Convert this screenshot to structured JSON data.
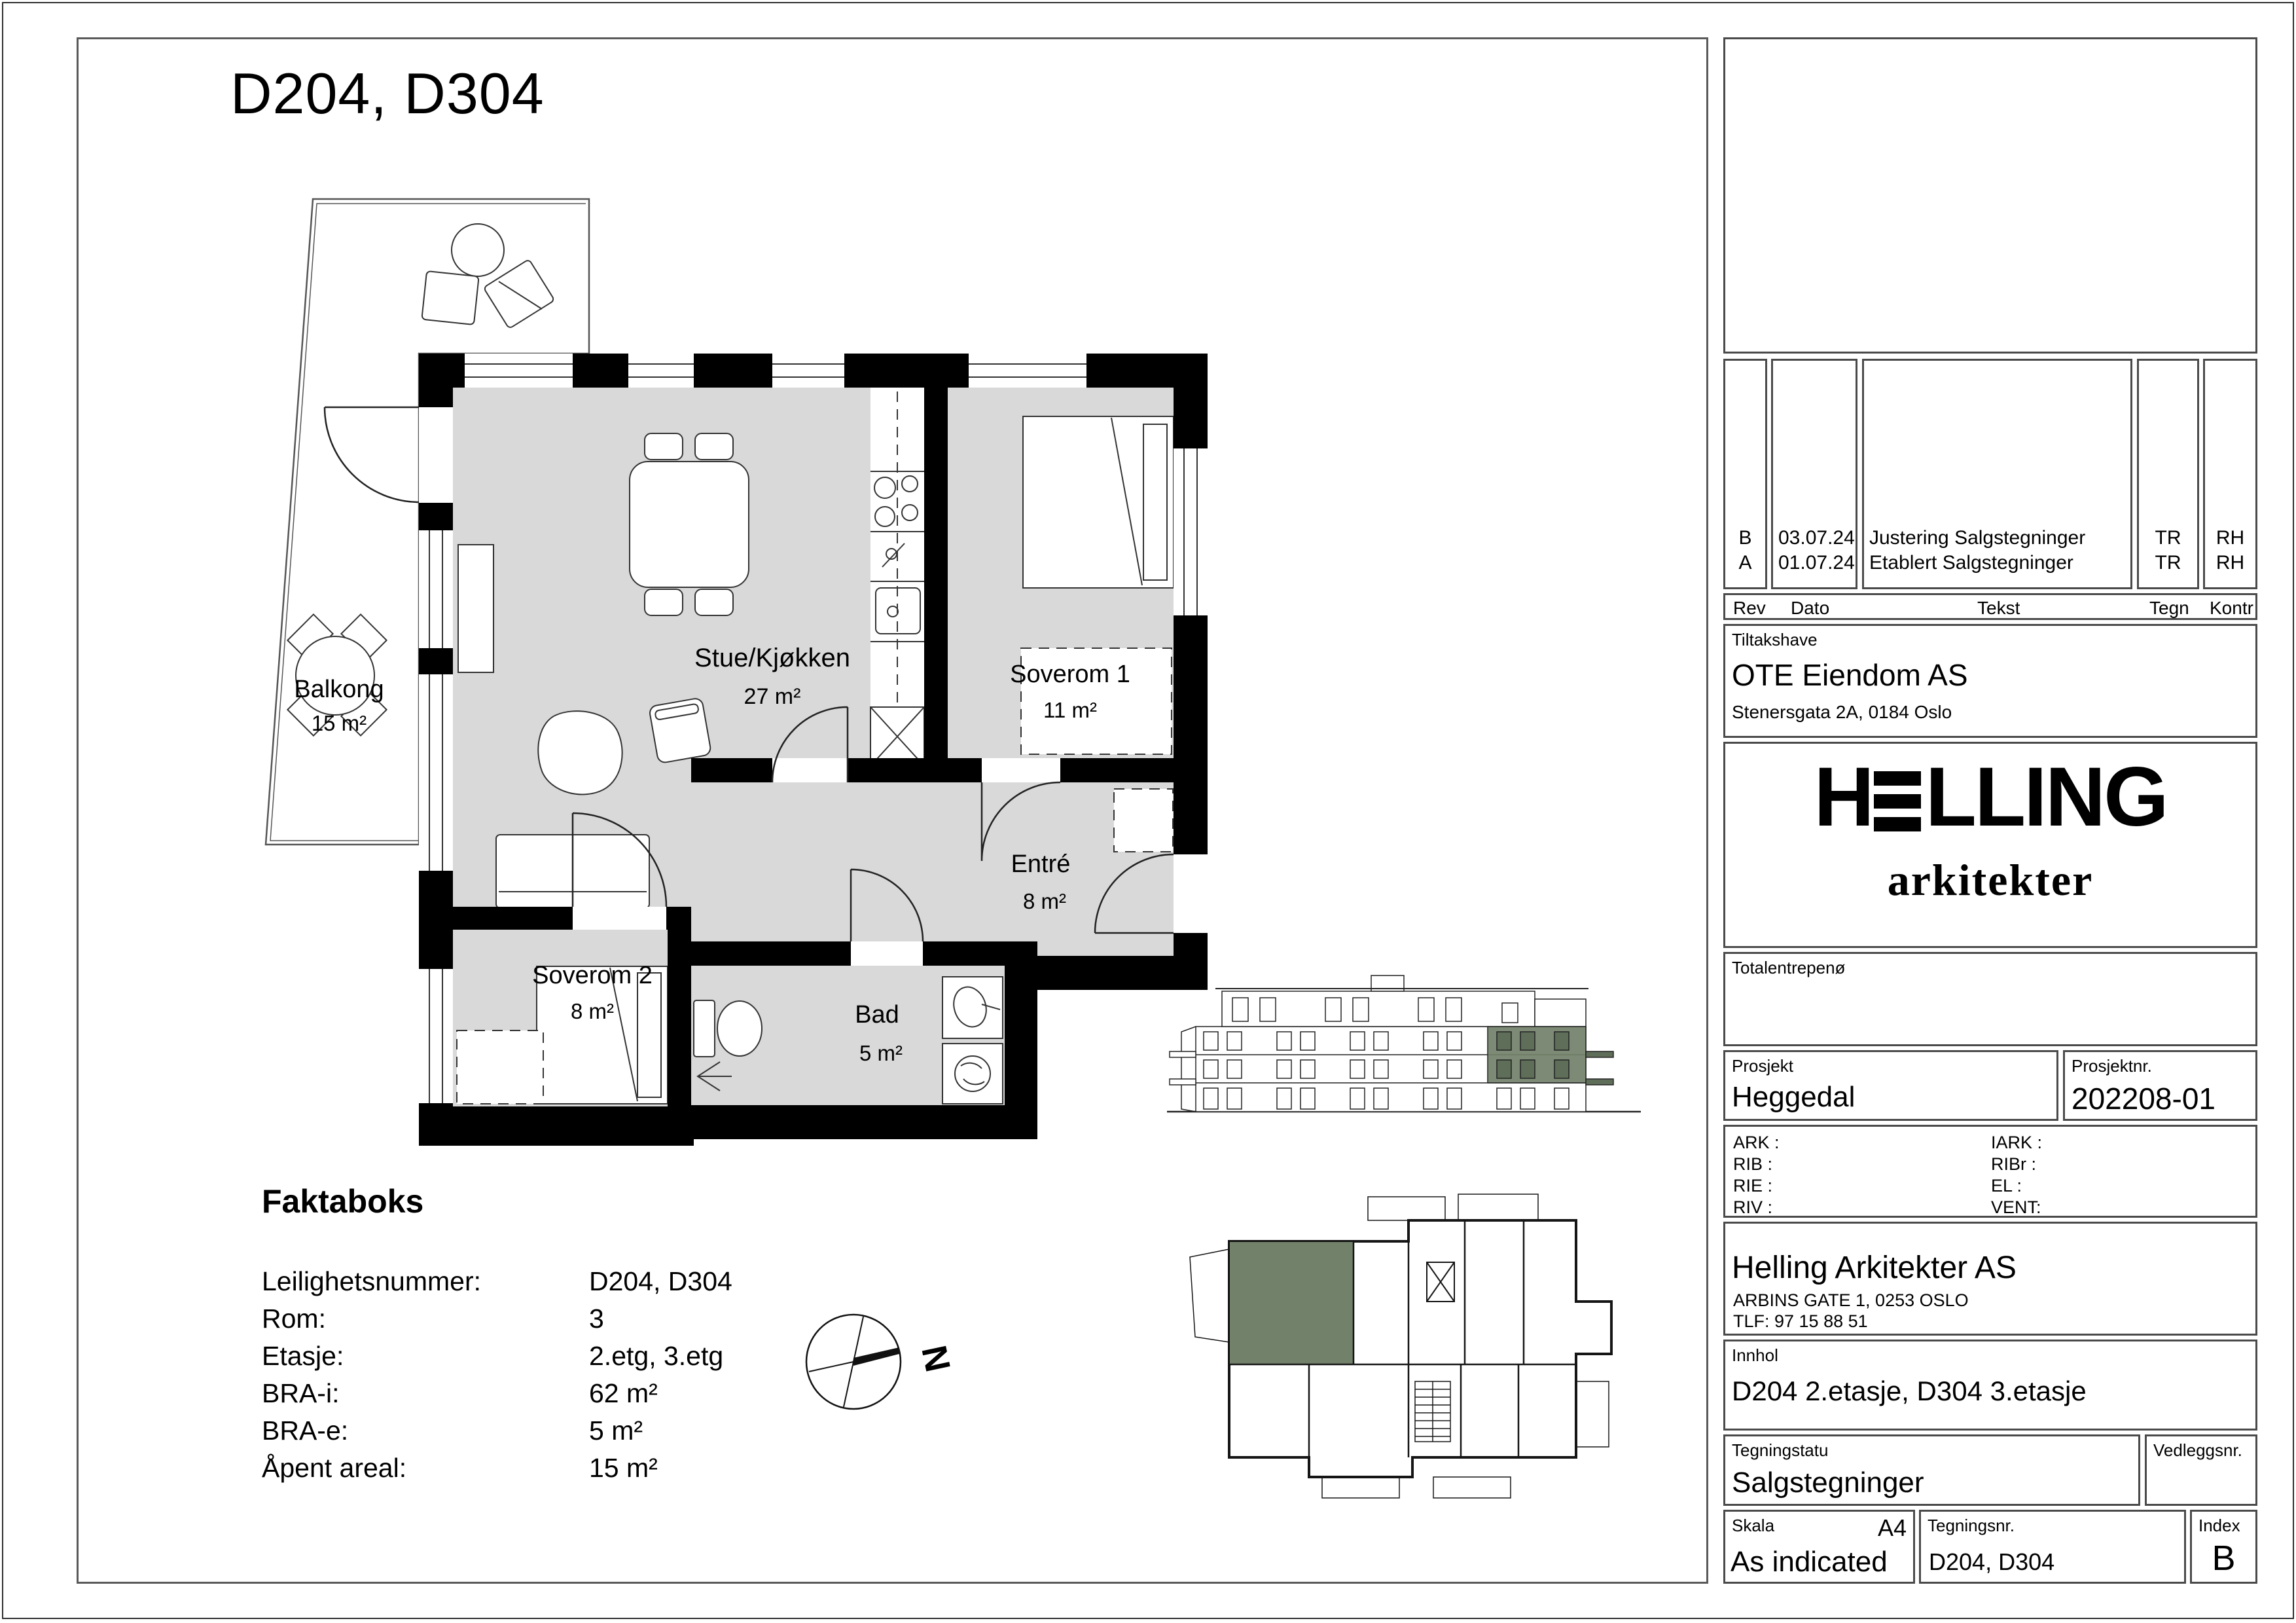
{
  "sheet": {
    "title": "D204, D304"
  },
  "plan": {
    "rooms": [
      {
        "name": "Balkong",
        "area": "15 m²"
      },
      {
        "name": "Stue/Kjøkken",
        "area": "27 m²"
      },
      {
        "name": "Soverom 1",
        "area": "11 m²"
      },
      {
        "name": "Soverom 2",
        "area": "8 m²"
      },
      {
        "name": "Entré",
        "area": "8 m²"
      },
      {
        "name": "Bad",
        "area": "5 m²"
      }
    ]
  },
  "faktaboks": {
    "title": "Faktaboks",
    "rows": [
      {
        "label": "Leilighetsnummer:",
        "value": "D204, D304"
      },
      {
        "label": "Rom:",
        "value": "3"
      },
      {
        "label": "Etasje:",
        "value": "2.etg, 3.etg"
      },
      {
        "label": "BRA-i:",
        "value": "62 m²"
      },
      {
        "label": "BRA-e:",
        "value": "5 m²"
      },
      {
        "label": "Åpent areal:",
        "value": "15 m²"
      }
    ]
  },
  "compass": {
    "north_label": "N"
  },
  "colors": {
    "highlight_green": "#72816a",
    "room_gray": "#d9d9d9"
  },
  "titleblock": {
    "revisions": {
      "headers": {
        "rev": "Rev",
        "dato": "Dato",
        "tekst": "Tekst",
        "tegn": "Tegn",
        "kontr": "Kontr"
      },
      "rows": [
        {
          "rev": "B",
          "dato": "03.07.24",
          "tekst": "Justering Salgstegninger",
          "tegn": "TR",
          "kontr": "RH"
        },
        {
          "rev": "A",
          "dato": "01.07.24",
          "tekst": "Etablert Salgstegninger",
          "tegn": "TR",
          "kontr": "RH"
        }
      ]
    },
    "tiltakshaver": {
      "label": "Tiltakshave",
      "name": "OTE Eiendom AS",
      "address": "Stenersgata 2A, 0184 Oslo"
    },
    "logo": {
      "h": "H",
      "rest": "LLING",
      "sub": "arkitekter"
    },
    "totalentreprenor_label": "Totalentrepenø",
    "prosjekt": {
      "label": "Prosjekt",
      "value": "Heggedal"
    },
    "prosjektnr": {
      "label": "Prosjektnr.",
      "value": "202208-01"
    },
    "consultants": {
      "left": [
        "ARK  :",
        "RIB   :",
        "RIE   :",
        "RIV   :"
      ],
      "right": [
        "IARK :",
        "RIBr  :",
        "EL     :",
        "VENT:"
      ]
    },
    "architect": {
      "name": "Helling Arkitekter AS",
      "address": "ARBINS GATE 1, 0253 OSLO",
      "phone": "TLF: 97 15 88 51"
    },
    "innhold": {
      "label": "Innhol",
      "value": "D204 2.etasje, D304 3.etasje"
    },
    "status": {
      "label": "Tegningstatu",
      "value": "Salgstegninger"
    },
    "vedlegg": {
      "label": "Vedleggsnr."
    },
    "skala": {
      "label": "Skala",
      "format": "A4",
      "value": "As indicated"
    },
    "tegningsnr": {
      "label": "Tegningsnr.",
      "value": "D204, D304"
    },
    "index": {
      "label": "Index",
      "value": "B"
    }
  }
}
